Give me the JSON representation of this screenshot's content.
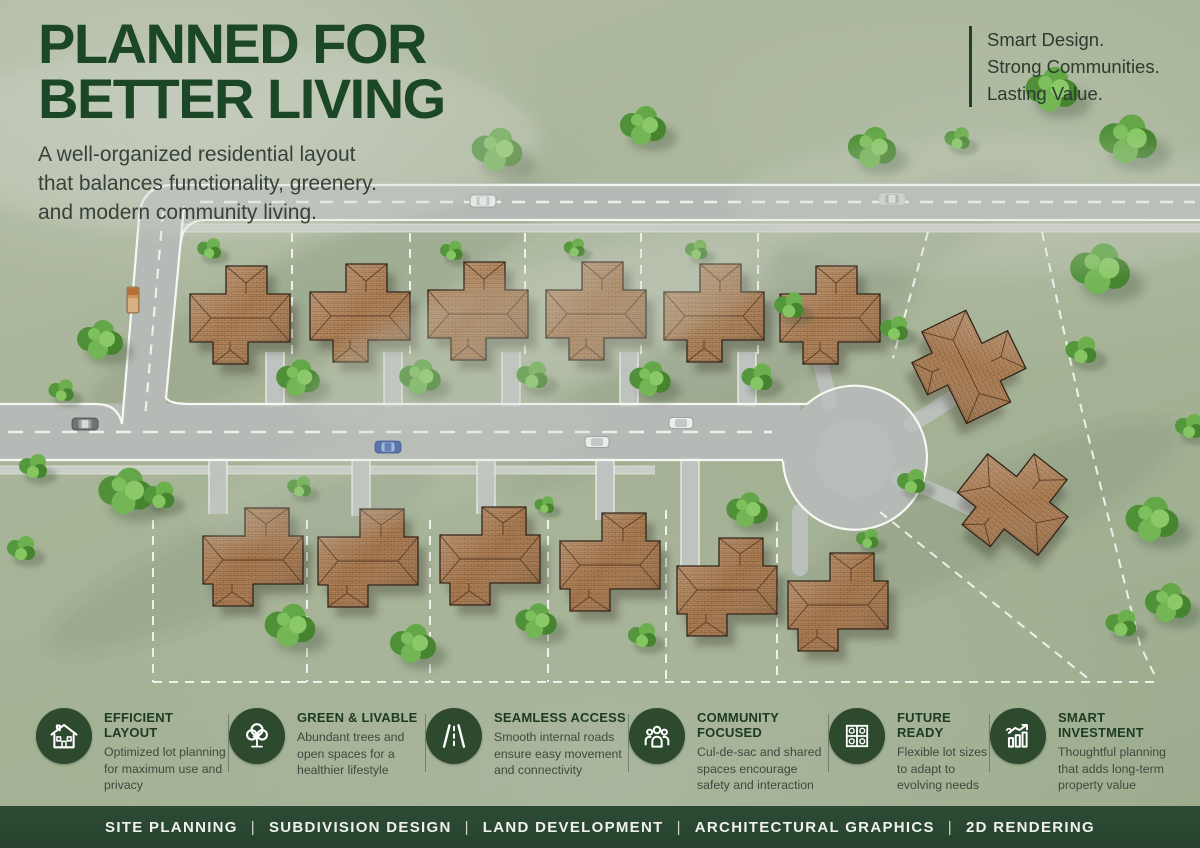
{
  "header": {
    "title_line1": "PLANNED FOR",
    "title_line2": "BETTER LIVING",
    "subtitle_lines": [
      "A well-organized residential layout",
      "that balances functionality, greenery.",
      "and modern community living."
    ]
  },
  "tagline": {
    "lines": [
      "Smart Design.",
      "Strong Communities.",
      "Lasting Value."
    ]
  },
  "features": {
    "items": [
      {
        "icon": "house-icon",
        "title": "EFFICIENT LAYOUT",
        "desc": "Optimized lot planning for maximum use and privacy"
      },
      {
        "icon": "tree-icon",
        "title": "GREEN & LIVABLE",
        "desc": "Abundant trees and open spaces for a healthier lifestyle"
      },
      {
        "icon": "road-icon",
        "title": "SEAMLESS ACCESS",
        "desc": "Smooth internal roads ensure easy movement and connectivity"
      },
      {
        "icon": "people-icon",
        "title": "COMMUNITY FOCUSED",
        "desc": "Cul-de-sac and shared spaces encourage safety and interaction"
      },
      {
        "icon": "lots-grid-icon",
        "title": "FUTURE READY",
        "desc": "Flexible lot sizes to adapt to evolving needs"
      },
      {
        "icon": "growth-chart-icon",
        "title": "SMART INVESTMENT",
        "desc": "Thoughtful planning that adds long-term property value"
      }
    ]
  },
  "footer": {
    "items": [
      "SITE PLANNING",
      "SUBDIVISION DESIGN",
      "LAND DEVELOPMENT",
      "ARCHITECTURAL GRAPHICS",
      "2D RENDERING"
    ],
    "separator": "|"
  },
  "colors": {
    "brand_green": "#1c4727",
    "footer_green": "#294631",
    "icon_circle_green": "#2d4a2f",
    "roof_terracotta": "#b08257",
    "grass_green": "#a7b497",
    "road_gray": "#b6bab6",
    "tree_green": "#579b3f",
    "lot_line_white": "#f2f4ee"
  }
}
